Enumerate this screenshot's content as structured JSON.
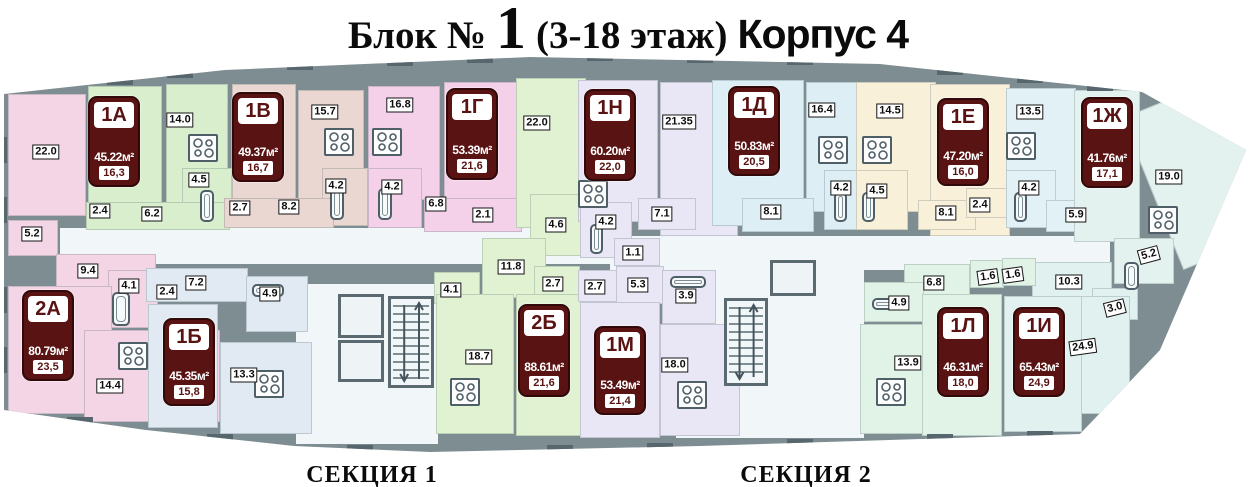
{
  "title": {
    "block": "Блок №",
    "number": "1",
    "floors": "(3-18 этаж)",
    "korpus": "Корпус 4"
  },
  "sections": [
    {
      "label": "СЕКЦИЯ 1",
      "x": 372,
      "y": 462
    },
    {
      "label": "СЕКЦИЯ 2",
      "x": 806,
      "y": 462
    }
  ],
  "palette": {
    "wall": "#7e8d92",
    "corridor": "#f1f6f8",
    "badge_bg": "#591313",
    "badge_text": "#ffffff",
    "label_border": "#141414",
    "units": {
      "2А": "#f4d5e5",
      "1А": "#d9eecd",
      "1В": "#ead7d1",
      "1Г": "#f4d1e9",
      "1Б": "#e1eaf2",
      "2Б": "#e0f2d2",
      "1Н": "#e9e7f5",
      "1М": "#e9e7f5",
      "1Д": "#ddeef5",
      "1Е": "#f9f0da",
      "1ИТ": "#e2f1f5",
      "1Ж": "#e4f2ef",
      "1И": "#e0f1f0",
      "1Л": "#e1f2e6"
    }
  },
  "units": [
    {
      "code": "1А",
      "area": "45.22м²",
      "living": "16,3",
      "x": 88,
      "y": 96,
      "h": 87
    },
    {
      "code": "1В",
      "area": "49.37м²",
      "living": "16,7",
      "x": 232,
      "y": 92,
      "h": 86
    },
    {
      "code": "1Г",
      "area": "53.39м²",
      "living": "21,6",
      "x": 446,
      "y": 88,
      "h": 88
    },
    {
      "code": "1Н",
      "area": "60.20м²",
      "living": "22,0",
      "x": 584,
      "y": 89,
      "h": 88
    },
    {
      "code": "1Д",
      "area": "50.83м²",
      "living": "20,5",
      "x": 728,
      "y": 86,
      "h": 86
    },
    {
      "code": "1Е",
      "area": "47.20м²",
      "living": "16,0",
      "x": 937,
      "y": 98,
      "h": 84
    },
    {
      "code": "1Ж",
      "area": "41.76м²",
      "living": "17,1",
      "x": 1081,
      "y": 97,
      "h": 87
    },
    {
      "code": "2А",
      "area": "80.79м²",
      "living": "23,5",
      "x": 22,
      "y": 290,
      "h": 87
    },
    {
      "code": "1Б",
      "area": "45.35м²",
      "living": "15,8",
      "x": 163,
      "y": 318,
      "h": 84
    },
    {
      "code": "2Б",
      "area": "88.61м²",
      "living": "21,6",
      "x": 518,
      "y": 304,
      "h": 89
    },
    {
      "code": "1М",
      "area": "53.49м²",
      "living": "21,4",
      "x": 594,
      "y": 326,
      "h": 85
    },
    {
      "code": "1Л",
      "area": "46.31м²",
      "living": "18,0",
      "x": 937,
      "y": 307,
      "h": 86
    },
    {
      "code": "1И",
      "area": "65.43м²",
      "living": "24,9",
      "x": 1013,
      "y": 307,
      "h": 86
    }
  ],
  "room_labels": [
    {
      "t": "22.0",
      "x": 46,
      "y": 152
    },
    {
      "t": "5.2",
      "x": 32,
      "y": 234
    },
    {
      "t": "9.4",
      "x": 88,
      "y": 271
    },
    {
      "t": "4.1",
      "x": 129,
      "y": 286
    },
    {
      "t": "14.4",
      "x": 110,
      "y": 386
    },
    {
      "t": "14.0",
      "x": 180,
      "y": 120
    },
    {
      "t": "4.5",
      "x": 199,
      "y": 180
    },
    {
      "t": "2.4",
      "x": 100,
      "y": 211
    },
    {
      "t": "6.2",
      "x": 152,
      "y": 214
    },
    {
      "t": "15.7",
      "x": 325,
      "y": 112
    },
    {
      "t": "2.7",
      "x": 240,
      "y": 208
    },
    {
      "t": "8.2",
      "x": 289,
      "y": 207
    },
    {
      "t": "4.2",
      "x": 336,
      "y": 186
    },
    {
      "t": "16.8",
      "x": 400,
      "y": 105
    },
    {
      "t": "4.2",
      "x": 392,
      "y": 187
    },
    {
      "t": "6.8",
      "x": 436,
      "y": 204
    },
    {
      "t": "2.1",
      "x": 483,
      "y": 215
    },
    {
      "t": "2.4",
      "x": 167,
      "y": 292
    },
    {
      "t": "7.2",
      "x": 196,
      "y": 283
    },
    {
      "t": "4.9",
      "x": 270,
      "y": 294
    },
    {
      "t": "13.3",
      "x": 244,
      "y": 375
    },
    {
      "t": "22.0",
      "x": 537,
      "y": 123
    },
    {
      "t": "4.6",
      "x": 556,
      "y": 225
    },
    {
      "t": "11.8",
      "x": 511,
      "y": 267
    },
    {
      "t": "4.1",
      "x": 451,
      "y": 290
    },
    {
      "t": "2.7",
      "x": 553,
      "y": 284
    },
    {
      "t": "18.7",
      "x": 479,
      "y": 357
    },
    {
      "t": "21.35",
      "x": 679,
      "y": 122
    },
    {
      "t": "4.2",
      "x": 606,
      "y": 222
    },
    {
      "t": "7.1",
      "x": 662,
      "y": 214
    },
    {
      "t": "1.1",
      "x": 633,
      "y": 253
    },
    {
      "t": "2.7",
      "x": 595,
      "y": 287
    },
    {
      "t": "5.3",
      "x": 638,
      "y": 285
    },
    {
      "t": "3.9",
      "x": 686,
      "y": 296
    },
    {
      "t": "18.0",
      "x": 675,
      "y": 365
    },
    {
      "t": "16.4",
      "x": 822,
      "y": 110
    },
    {
      "t": "4.2",
      "x": 841,
      "y": 188
    },
    {
      "t": "8.1",
      "x": 771,
      "y": 212
    },
    {
      "t": "14.5",
      "x": 890,
      "y": 111
    },
    {
      "t": "4.5",
      "x": 877,
      "y": 191
    },
    {
      "t": "8.1",
      "x": 946,
      "y": 213
    },
    {
      "t": "2.4",
      "x": 980,
      "y": 205
    },
    {
      "t": "13.5",
      "x": 1030,
      "y": 112
    },
    {
      "t": "4.2",
      "x": 1029,
      "y": 188
    },
    {
      "t": "5.9",
      "x": 1076,
      "y": 215
    },
    {
      "t": "19.0",
      "x": 1169,
      "y": 177
    },
    {
      "t": "5.2",
      "x": 1149,
      "y": 255,
      "r": -15
    },
    {
      "t": "6.8",
      "x": 934,
      "y": 283
    },
    {
      "t": "4.9",
      "x": 899,
      "y": 303
    },
    {
      "t": "13.9",
      "x": 908,
      "y": 363
    },
    {
      "t": "1.6",
      "x": 988,
      "y": 277,
      "r": -8
    },
    {
      "t": "1.6",
      "x": 1013,
      "y": 275,
      "r": -8
    },
    {
      "t": "10.3",
      "x": 1069,
      "y": 282
    },
    {
      "t": "3.0",
      "x": 1115,
      "y": 308,
      "r": -14
    },
    {
      "t": "24.9",
      "x": 1083,
      "y": 347,
      "r": -8
    }
  ]
}
